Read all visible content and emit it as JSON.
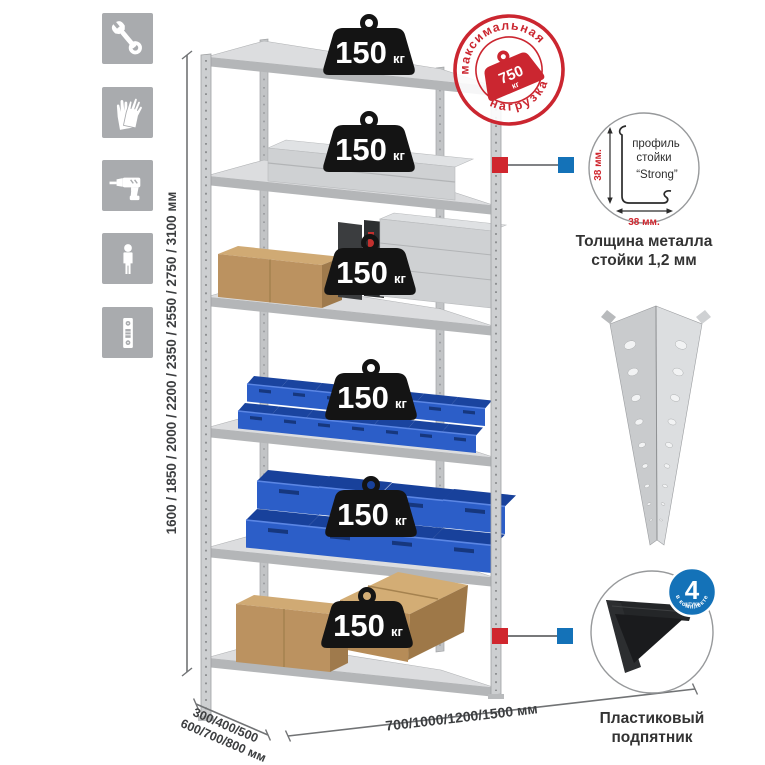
{
  "colors": {
    "accent_red": "#d0262e",
    "accent_blue": "#1472b8",
    "bin_blue": "#2c5ec8",
    "badge_black": "#141414",
    "metal_gray": "#cdcfd1",
    "icon_tile_gray": "#a9abae",
    "cardboard": "#bb9260"
  },
  "icon_rail": {
    "icons": [
      {
        "name": "wrench-icon"
      },
      {
        "name": "gloves-icon"
      },
      {
        "name": "drill-icon"
      },
      {
        "name": "person-icon"
      },
      {
        "name": "upright-profile-icon"
      }
    ]
  },
  "rack": {
    "shelf_badges": [
      {
        "value": "150",
        "unit": "кг"
      },
      {
        "value": "150",
        "unit": "кг"
      },
      {
        "value": "150",
        "unit": "кг"
      },
      {
        "value": "150",
        "unit": "кг"
      },
      {
        "value": "150",
        "unit": "кг"
      },
      {
        "value": "150",
        "unit": "кг"
      }
    ]
  },
  "max_load_stamp": {
    "arc_top": "максимальная",
    "arc_bottom": "нагрузка",
    "weight_value": "750",
    "weight_unit": "кг"
  },
  "dimensions": {
    "height": "1600 / 1850 / 2000 / 2200 / 2350 / 2550 / 2750 / 3100 мм",
    "depth_line1": "300/400/500",
    "depth_line2": "600/700/800 мм",
    "width": "700/1000/1200/1500 мм"
  },
  "profile_detail": {
    "label_line1": "профиль",
    "label_line2": "стойки",
    "label_line3": "“Strong”",
    "dim_side": "38 мм.",
    "dim_bottom": "38 мм.",
    "caption_line1": "Толщина металла",
    "caption_line2": "стойки 1,2 мм"
  },
  "foot_detail": {
    "badge_number": "4",
    "badge_sub": "штуки",
    "badge_arc": "в комплекте",
    "caption_line1": "Пластиковый",
    "caption_line2": "подпятник"
  }
}
